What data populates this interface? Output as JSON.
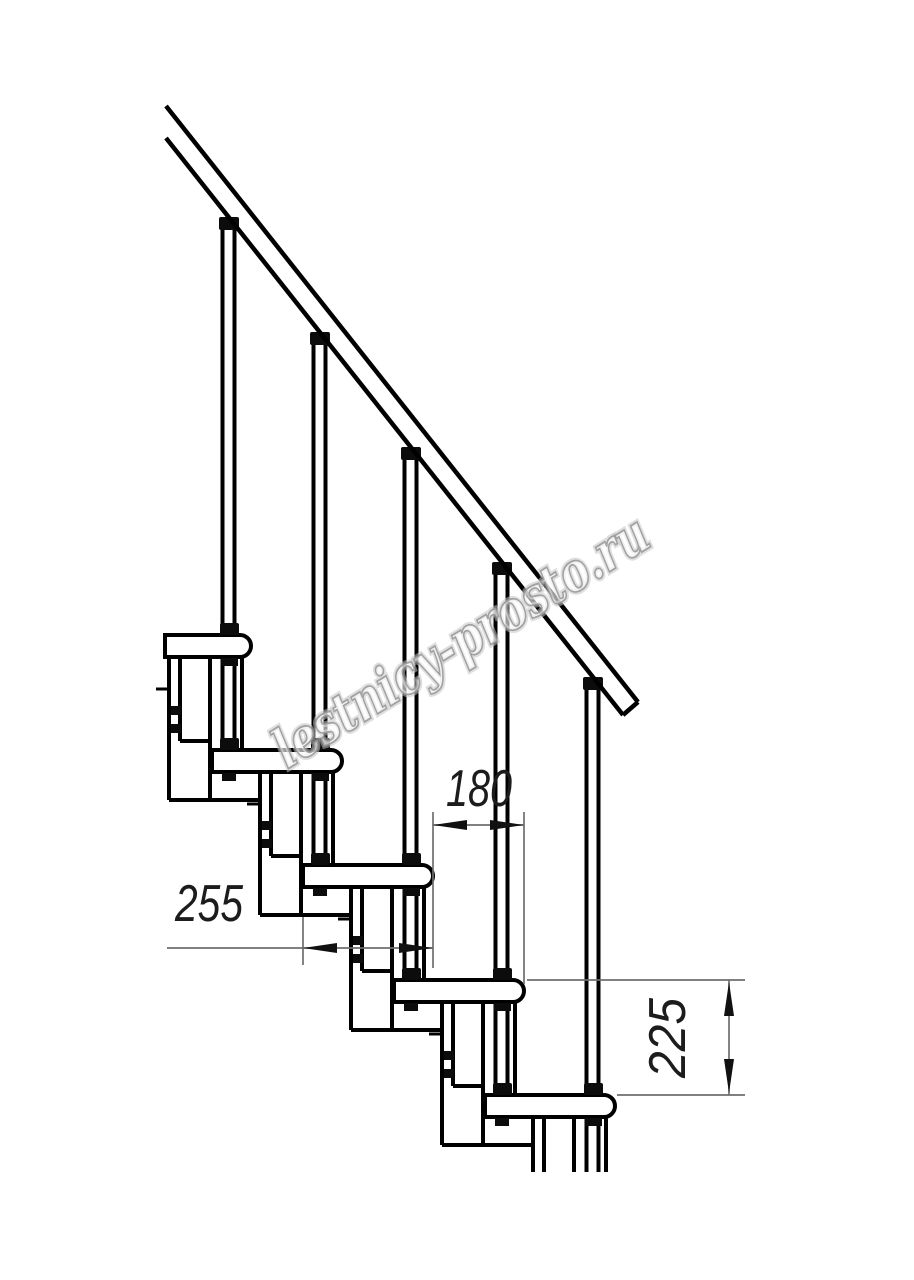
{
  "title": "Modular staircase side-view technical drawing",
  "watermark": {
    "text": "lestnicy-prosto.ru",
    "color": "#a8a8a8"
  },
  "dimensions": {
    "going": {
      "value": "180"
    },
    "tread_depth": {
      "value": "255"
    },
    "rise": {
      "value": "225"
    }
  },
  "colors": {
    "background": "#ffffff",
    "structure_line": "#000000",
    "dimension_line": "#6e6e6e",
    "dimension_text": "#1c1c1c"
  }
}
